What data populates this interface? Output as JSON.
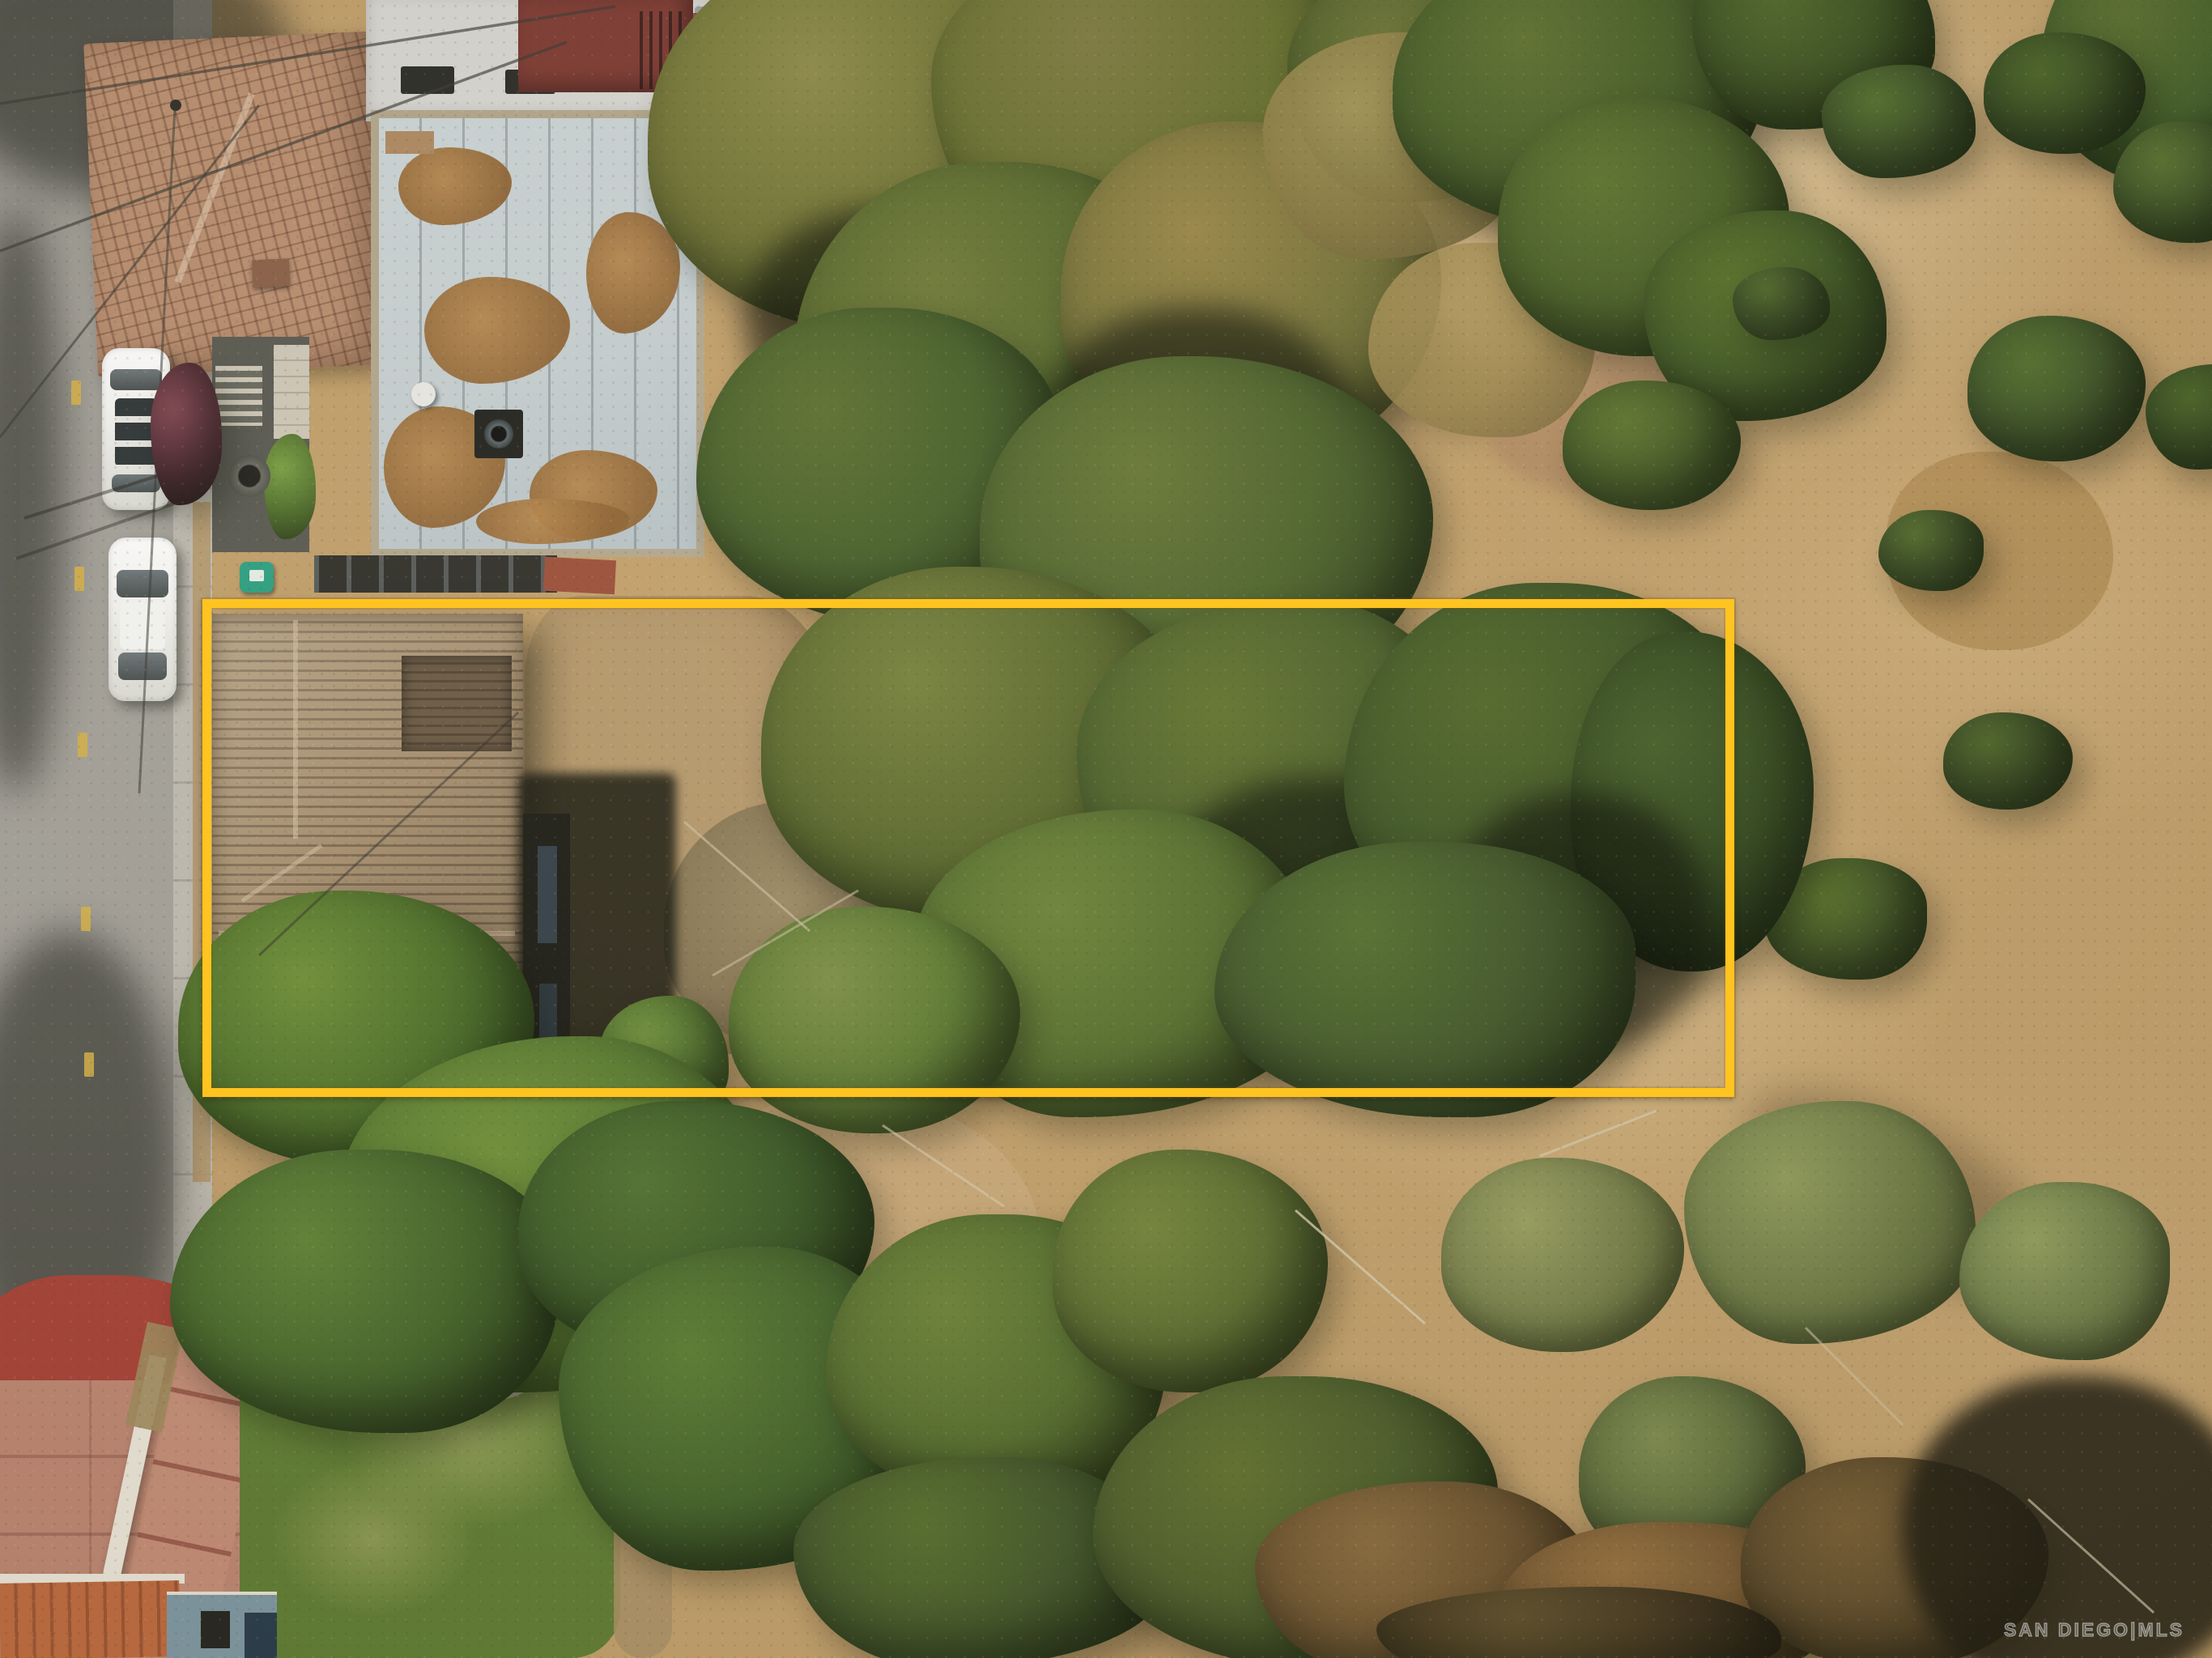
{
  "watermark": {
    "text": "SAN DIEGO|MLS"
  },
  "palette": {
    "boundary-yellow": "#FFC41F",
    "road-gray": "#A5A29B",
    "sidewalk-gray": "#C0BCB2",
    "dirt-tan": "#B5986B",
    "dry-grass": "#C2A06B",
    "dry-grass-light": "#DCC497",
    "canopy-green": "#4E662B",
    "canopy-olive": "#6E7233",
    "canopy-dark": "#26361A",
    "canopy-sage": "#77804A",
    "shingle-brown": "#A18A69",
    "tile-terracotta": "#B4876A",
    "flat-roof-gray": "#C6CFD1",
    "lawn-green": "#5F7D33",
    "walkway-red": "#A84136",
    "walkway-salmon": "#BE8672",
    "white-trim": "#ECE7DA",
    "car-white": "#F4F4F1",
    "bin-green": "#2EA182",
    "watermark-gray": "#DCDCDC"
  }
}
